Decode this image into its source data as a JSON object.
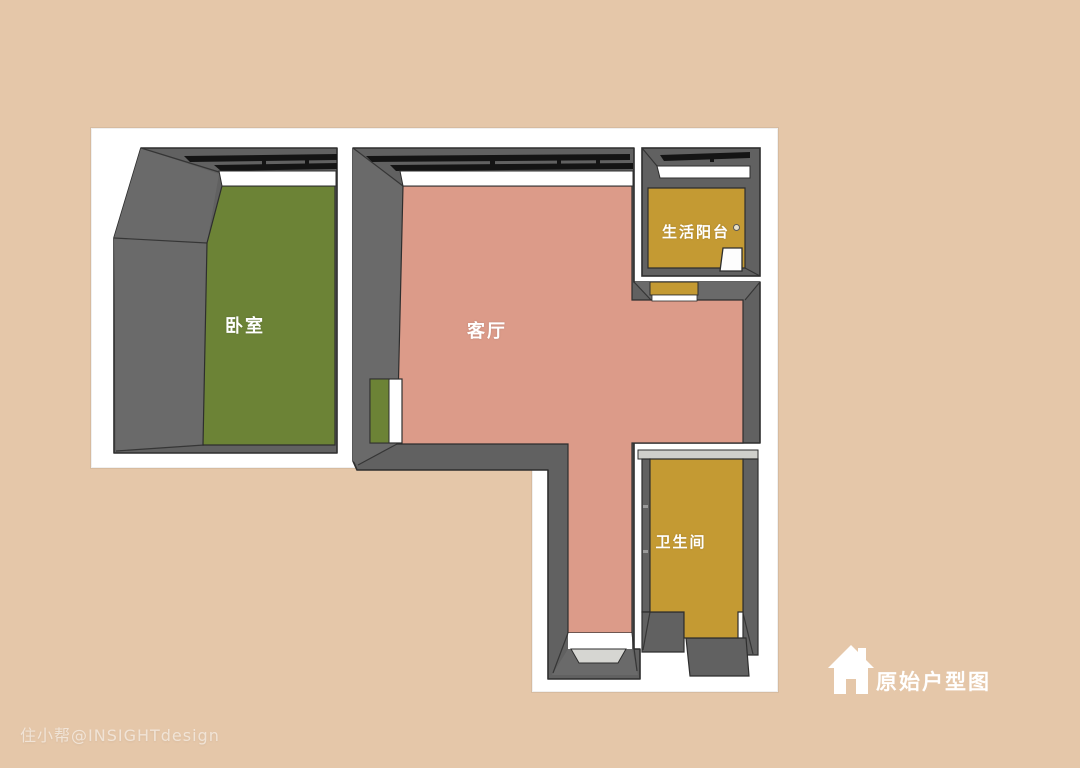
{
  "plan": {
    "rooms": {
      "bedroom": {
        "label": "卧室",
        "floor_color": "#6c8336"
      },
      "living": {
        "label": "客厅",
        "floor_color": "#dc9b89"
      },
      "balcony": {
        "label": "生活阳台",
        "floor_color": "#c49a33"
      },
      "bathroom": {
        "label": "卫生间",
        "floor_color": "#c49a33"
      }
    },
    "colors": {
      "background": "#e5c7a9",
      "backdrop": "#ffffff",
      "wall": "#616161",
      "wall_face_light": "#6a6a6a",
      "wall_outline": "#2e2e2e",
      "window_frame": "#141414",
      "window_sill": "#ffffff",
      "door_panel": "#d6d6d2",
      "bathroom_top_edge": "#cfcfcb",
      "appliance": "#fdfdfd",
      "label_text": "#ffffff"
    }
  },
  "caption": {
    "title": "原始户型图",
    "icon": "house-icon"
  },
  "watermark": "住小帮@INSIGHTdesign"
}
